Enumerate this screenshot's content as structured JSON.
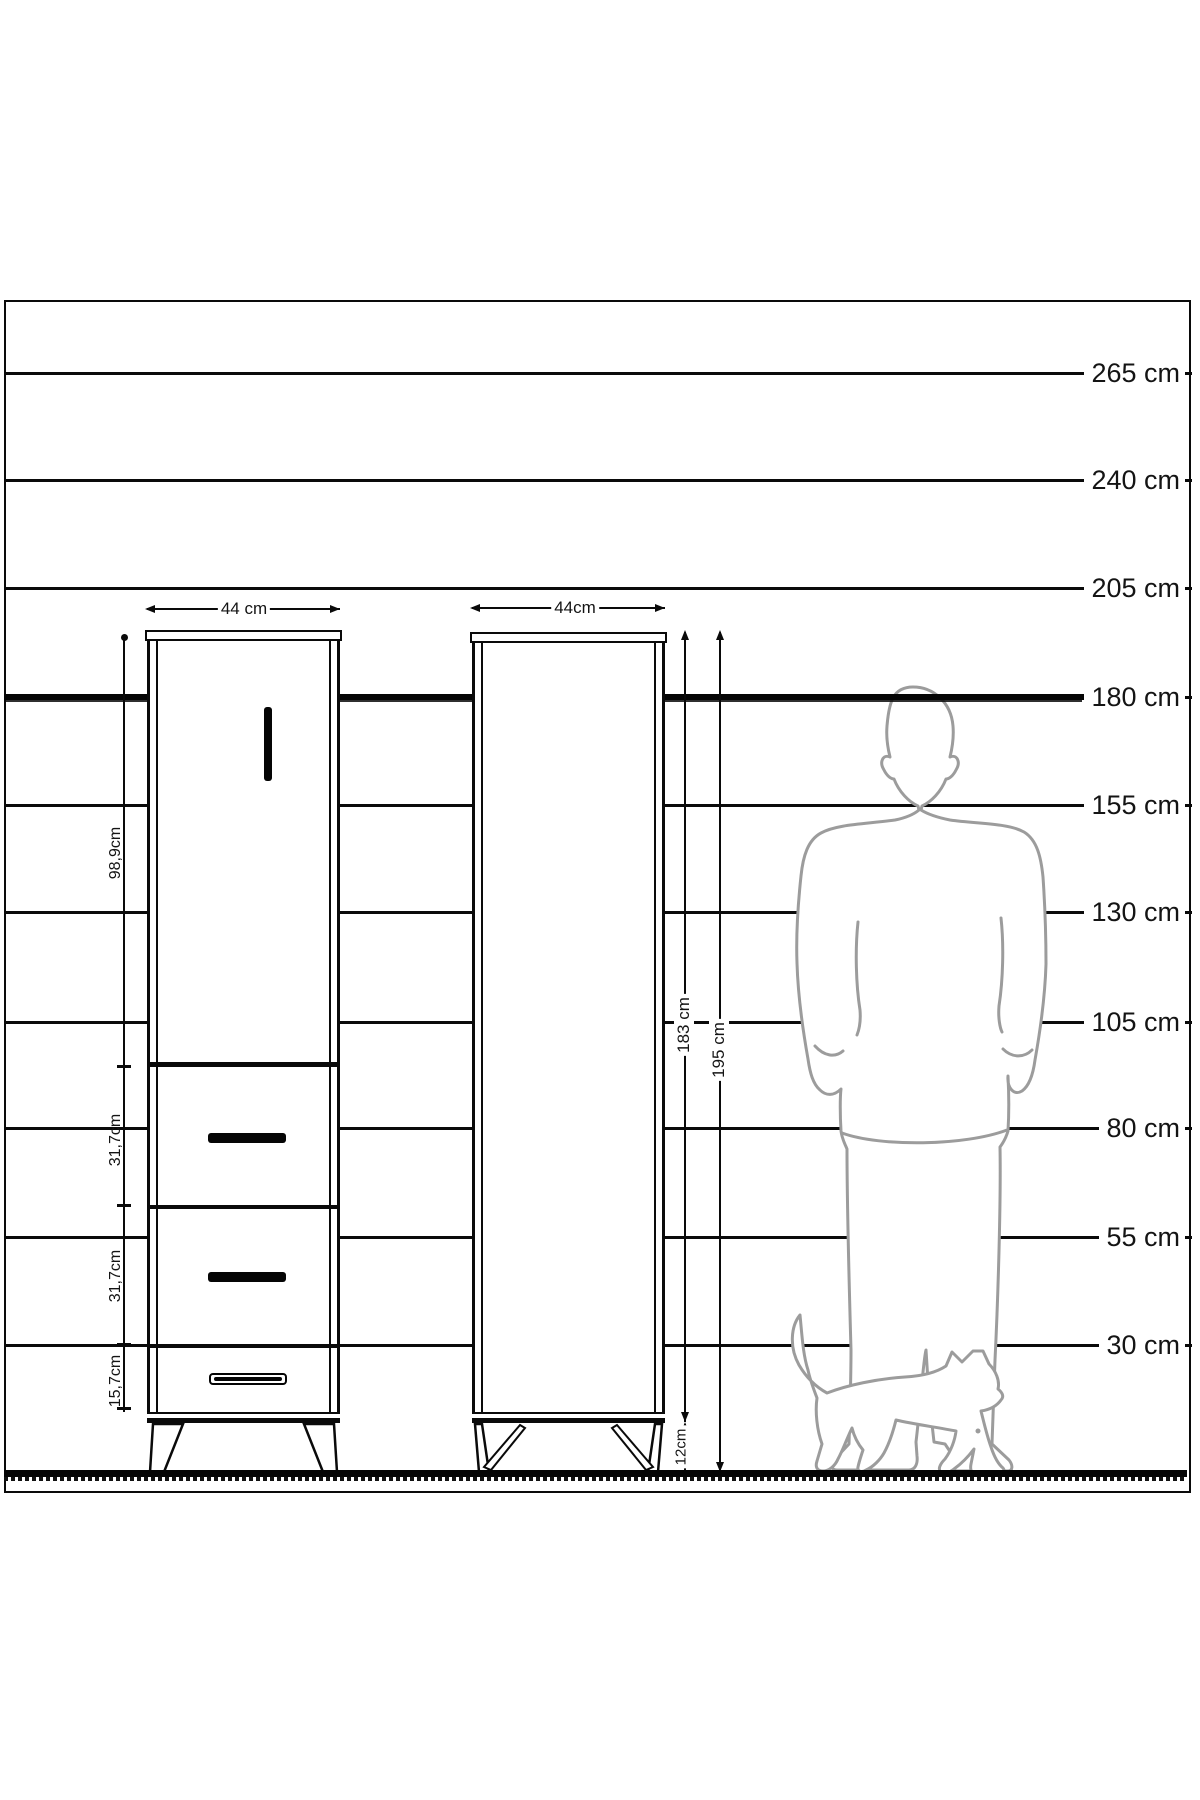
{
  "scale": {
    "unit_lines": [
      {
        "label": "265 cm",
        "y": 373,
        "thick": false
      },
      {
        "label": "240 cm",
        "y": 480,
        "thick": false
      },
      {
        "label": "205 cm",
        "y": 588,
        "thick": false
      },
      {
        "label": "180 cm",
        "y": 697,
        "thick": true
      },
      {
        "label": "155 cm",
        "y": 805,
        "thick": false
      },
      {
        "label": "130 cm",
        "y": 912,
        "thick": false
      },
      {
        "label": "105 cm",
        "y": 1022,
        "thick": false
      },
      {
        "label": "80 cm",
        "y": 1128,
        "thick": false
      },
      {
        "label": "55 cm",
        "y": 1237,
        "thick": false
      },
      {
        "label": "30 cm",
        "y": 1345,
        "thick": false
      }
    ]
  },
  "cabinet1": {
    "width_label": "44 cm",
    "sections": [
      {
        "label": "98,9cm"
      },
      {
        "label": "31,7cm"
      },
      {
        "label": "31,7cm"
      },
      {
        "label": "15,7cm"
      }
    ]
  },
  "cabinet2": {
    "width_label": "44cm",
    "body_height_label": "183 cm",
    "total_height_label": "195 cm",
    "leg_height_label": "12cm"
  }
}
